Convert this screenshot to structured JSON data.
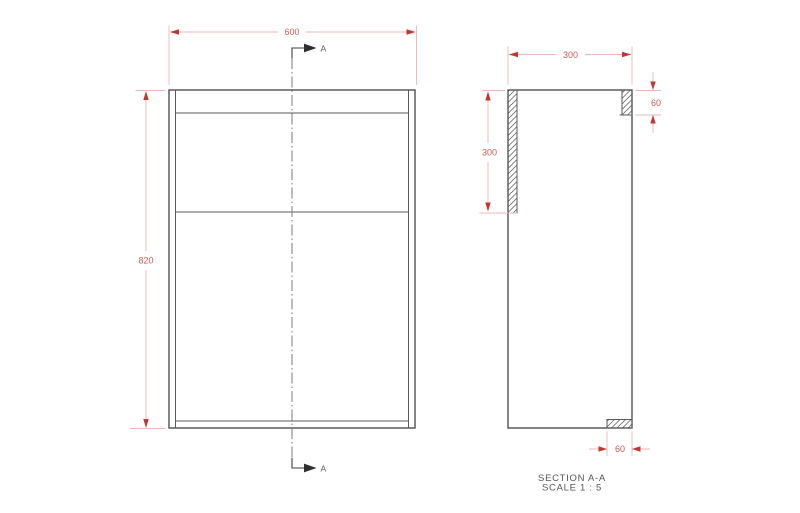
{
  "dims": {
    "front_width": "600",
    "front_height": "820",
    "side_depth": "300",
    "back_panel": "300",
    "top_rail": "60",
    "bottom_rail": "60"
  },
  "section": {
    "top_label": "A",
    "bottom_label": "A"
  },
  "title": {
    "name": "SECTION A-A",
    "scale": "SCALE 1 : 5"
  },
  "colors": {
    "edge": "#4f5052",
    "centerline": "#7a7b7e",
    "dimension_line": "#efb5b5",
    "dimension_arrow": "#c23630",
    "dimension_text": "#ce5a55",
    "annotation_text": "#55565a",
    "background": "#ffffff"
  }
}
